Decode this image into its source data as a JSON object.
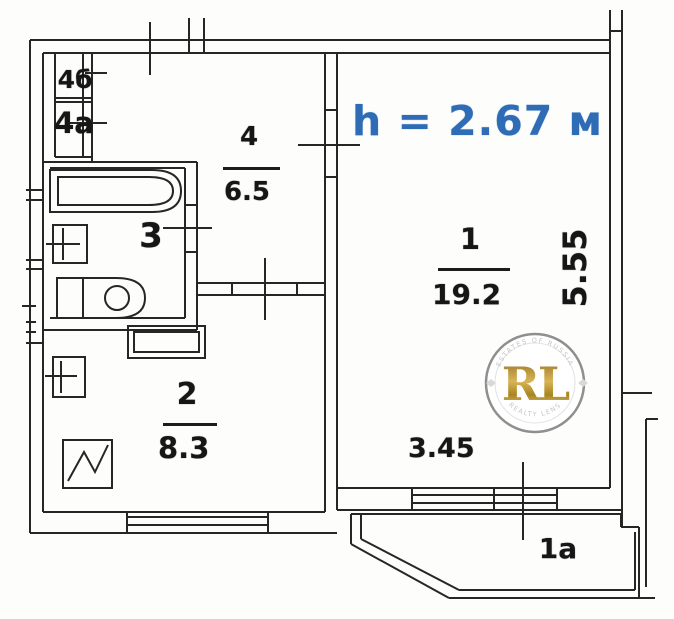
{
  "title": "Apartment floor plan (scanned)",
  "ceiling_height_label": "h = 2.67 м",
  "rooms": {
    "room1": {
      "number": "1",
      "area": "19.2"
    },
    "room2": {
      "number": "2",
      "area": "8.3"
    },
    "room3": {
      "number": "3"
    },
    "room4": {
      "number": "4",
      "area": "6.5"
    },
    "closet_top": {
      "number": "4б"
    },
    "closet_bottom": {
      "number": "4а"
    },
    "balcony": {
      "number": "1а"
    }
  },
  "dimensions": {
    "room1_width": "3.45",
    "room1_depth": "5.55"
  },
  "watermark": {
    "initials": "RL",
    "arc_top": "ESTATES OF RUSSIA",
    "arc_bottom": "REALTY LENS"
  },
  "colors": {
    "wall_line": "#262626",
    "height_text": "#2e6cb6",
    "gold": "#c2a044",
    "watermark_ring": "#8f8f8f"
  }
}
